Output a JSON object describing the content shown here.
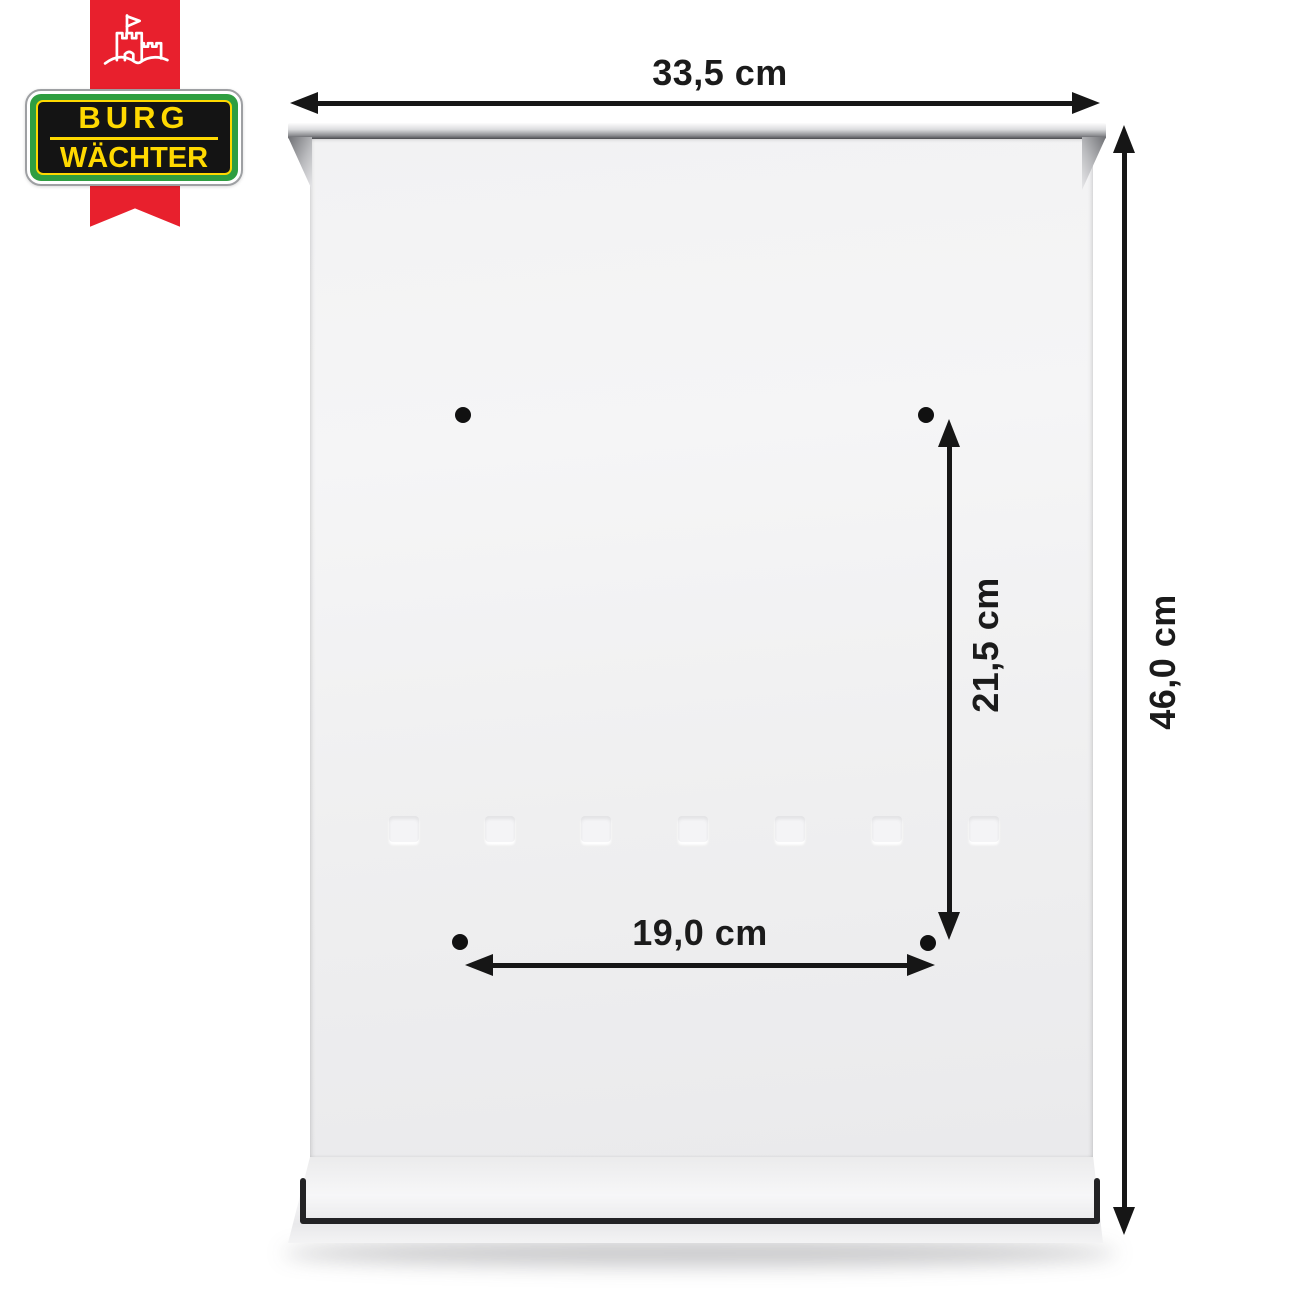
{
  "badge": {
    "brand_line1": "BURG",
    "brand_line2": "WÄCHTER",
    "castle_icon": "castle-with-flag",
    "colors": {
      "ribbon_red": "#e8202d",
      "plate_green": "#2f9e41",
      "plate_black": "#141414",
      "brand_yellow": "#ffd900"
    }
  },
  "product": {
    "name": "mailbox rear panel",
    "body_color": "#f1f1f2",
    "mounting_holes_count": 4,
    "embossed_slots_count": 7
  },
  "dimensions": {
    "overall_width": "33,5 cm",
    "overall_height": "46,0 cm",
    "hole_spacing_vertical": "21,5 cm",
    "hole_spacing_horizontal": "19,0 cm",
    "arrow_color": "#161616"
  }
}
